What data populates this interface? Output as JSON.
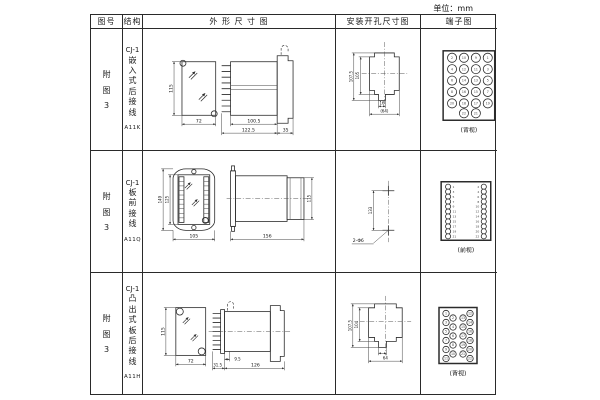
{
  "unit_label": "单位：mm",
  "header": [
    "图号",
    "结构",
    "外 形 尺 寸 图",
    "安装开孔尺寸图",
    "端子图"
  ],
  "rows": [
    {
      "figure_chars": [
        "附",
        "图",
        "3"
      ],
      "model": "CJ-1",
      "structure_chars": [
        "嵌",
        "入",
        "式",
        "后",
        "接",
        "线"
      ],
      "code": "A11K",
      "outline_dims": {
        "front_height": "115",
        "front_width": "72",
        "body_length": "100.5",
        "overall_length": "122.5",
        "flange_depth": "35"
      },
      "mounting_dims": {
        "outer_height": "107.5",
        "inner_height": "105",
        "notch_width": "16",
        "overall_width": "(64)"
      },
      "terminal_diagram": {
        "view_label": "(背视)",
        "pattern": "grid",
        "numbers": [
          [
            2,
            10,
            9,
            1
          ],
          [
            4,
            12,
            11,
            3
          ],
          [
            6,
            14,
            13,
            5
          ],
          [
            8,
            16,
            15,
            7
          ],
          [
            20,
            18,
            17,
            19
          ],
          [
            22,
            21
          ]
        ]
      }
    },
    {
      "figure_chars": [
        "附",
        "图",
        "3"
      ],
      "model": "CJ-1",
      "structure_chars": [
        "板",
        "前",
        "接",
        "线"
      ],
      "code": "A11Q",
      "outline_dims": {
        "front_outer_height": "149",
        "front_inner_height": "125",
        "front_width": "105",
        "side_length": "156",
        "side_height": "115"
      },
      "mounting_dims": {
        "hole_spacing": "133",
        "hole_spec": "2-Φ6"
      },
      "terminal_diagram": {
        "view_label": "(前视)",
        "pattern": "columns",
        "left_numbers": [
          1,
          3,
          5,
          7,
          9,
          11,
          13,
          15,
          17,
          19,
          21
        ],
        "right_numbers": [
          2,
          4,
          6,
          8,
          10,
          12,
          14,
          16,
          18,
          20,
          22
        ]
      }
    },
    {
      "figure_chars": [
        "附",
        "图",
        "3"
      ],
      "model": "CJ-1",
      "structure_chars": [
        "凸",
        "出",
        "式",
        "板",
        "后",
        "接",
        "线"
      ],
      "code": "A11H",
      "outline_dims": {
        "front_height": "115",
        "front_width": "72",
        "pin_length": "31.5",
        "pin_offset": "9.5",
        "body_length": "126"
      },
      "mounting_dims": {
        "outer_height": "107.5",
        "inner_height": "104",
        "overall_width": "64"
      },
      "terminal_diagram": {
        "view_label": "(背视)",
        "pattern": "staggered",
        "numbers": [
          1,
          2,
          3,
          4,
          5,
          6,
          7,
          8,
          9,
          10,
          11,
          12,
          13,
          14,
          15,
          16,
          17,
          18,
          19,
          20,
          21,
          22
        ]
      }
    }
  ]
}
